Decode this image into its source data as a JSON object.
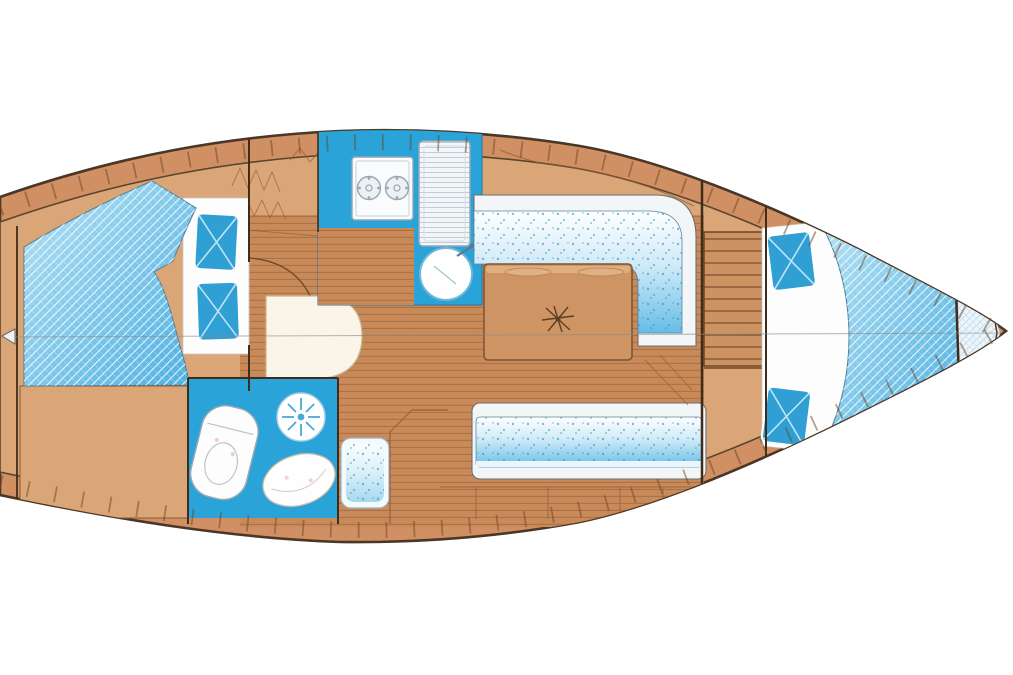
{
  "diagram": {
    "type": "sailing-yacht-interior-floor-plan",
    "orientation": "bow-left-stern-right",
    "visible_text": [],
    "colors": {
      "background": "#ffffff",
      "hull_band": "#d09063",
      "hull_outline": "#4a3726",
      "interior_base": "#dba677",
      "floor_plank": "#c98a5a",
      "plank_line": "#aa6f41",
      "counter_blue": "#2aa3d8",
      "head_floor_blue": "#2aa3d8",
      "cushion_blue": "#66bde6",
      "mattress_blue_light": "#b4e1f4",
      "mattress_blue_deep": "#4eb0e1",
      "pillow_blue": "#2f9fd4",
      "table_wood": "#cf9464",
      "fixture_white": "#fbfcfd",
      "lazarette_tint": "#eef6fb",
      "line_dark": "#3e2d1c"
    },
    "regions": {
      "bow_arrow": "bow direction marker",
      "v_berth": "forward V-berth with hatched double mattress and two pillows",
      "hanging_locker": "forward cabin lockers and shelves",
      "head": "toilet compartment with WC, washbasin and shower rose",
      "washbasin_unit": "rounded vanity unit beside forward bulkhead",
      "nav_seat": "small seat cushion beside head compartment",
      "galley_stove": "two-burner stove in blue counter",
      "galley_fridge": "refrigerator / lined counter",
      "galley_sink": "round sink with faucet",
      "saloon_floor": "planked saloon sole",
      "saloon_table": "saloon table with centre leg and two fiddled recesses",
      "port_settee": "L-shaped dotted settee",
      "starboard_settee": "straight dotted settee",
      "companionway": "companionway steps between bulkheads",
      "aft_cabin": "aft double berth, butterfly mattress with two pillows",
      "lazarette": "stern locker with light cross-hatch",
      "centerline": "hull centreline"
    }
  }
}
